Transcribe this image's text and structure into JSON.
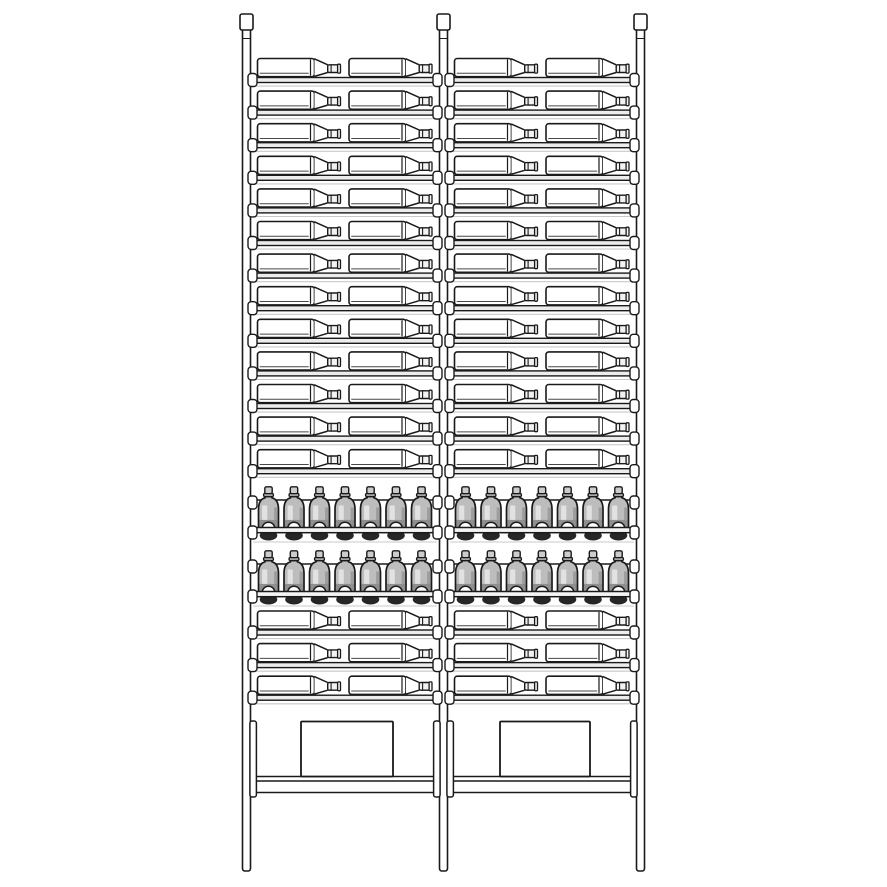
{
  "illustration": {
    "subject": "two-bay wine storage rack line drawing",
    "style": "technical product illustration, black outlines on white"
  },
  "canvas": {
    "width": 887,
    "height": 887,
    "background": "#ffffff"
  },
  "palette": {
    "line": "#1a1a1a",
    "inner_line": "#474747",
    "shelf_fill": "#ececec",
    "rail_fill": "#f4f4f4",
    "shadow_line": "#c9c9c9",
    "glass_mid": "#bdbdbd",
    "glass_light": "#e2e2e2",
    "glass_dark": "#9d9d9d",
    "glass_deep": "#8f8f8f",
    "base_dark": "#262626",
    "neck_fill": "#f2f2f2",
    "cap_fill": "#cccccc",
    "flange_fill": "#d6d6d6",
    "white": "#ffffff"
  },
  "rack": {
    "posts": {
      "x": [
        242.5,
        439.5,
        636.5
      ],
      "width": 8,
      "body_top_y": 28,
      "bottom_y": 871,
      "cap": {
        "y": 14,
        "width": 13,
        "height": 16
      },
      "joint_y": 38.5
    },
    "bays": [
      {
        "left": 250.5,
        "right": 439.5
      },
      {
        "left": 447.5,
        "right": 636.5
      }
    ],
    "upper_lying_rows": {
      "count": 13,
      "first_shelf_y": 77.5,
      "pitch": 32.6
    },
    "lower_lying_rows": {
      "count": 3,
      "first_shelf_y": 630,
      "pitch": 32.6
    },
    "lying_bottle": {
      "offsets": [
        7,
        98.5
      ],
      "body_length": 57,
      "total_length": 83,
      "height": 19
    },
    "standing_rows": {
      "rail_y": [
        527.5,
        591.5
      ],
      "bottles_per_row": 7,
      "pitch": 25.5,
      "first_center_offset": 18,
      "bottle_width": 20,
      "bottle_height": 41,
      "back_line_rise": 27.5
    },
    "bottom": {
      "collar": {
        "y": 721,
        "width": 6.5,
        "height": 76
      },
      "floor_y": 776.5,
      "base_rail": {
        "x": 250.5,
        "y": 781,
        "width": 386,
        "height": 11.5
      },
      "boxes": [
        {
          "x": 301,
          "width": 92
        },
        {
          "x": 500,
          "width": 90
        }
      ],
      "box_y": 721.5,
      "box_height": 55
    },
    "clip": {
      "width": 9,
      "height": 13
    }
  },
  "inventory": {
    "bays": 2,
    "lying_rows_total": 16,
    "lying_bottles_total": 64,
    "standing_rows_total": 2,
    "standing_bottles_total": 28
  }
}
